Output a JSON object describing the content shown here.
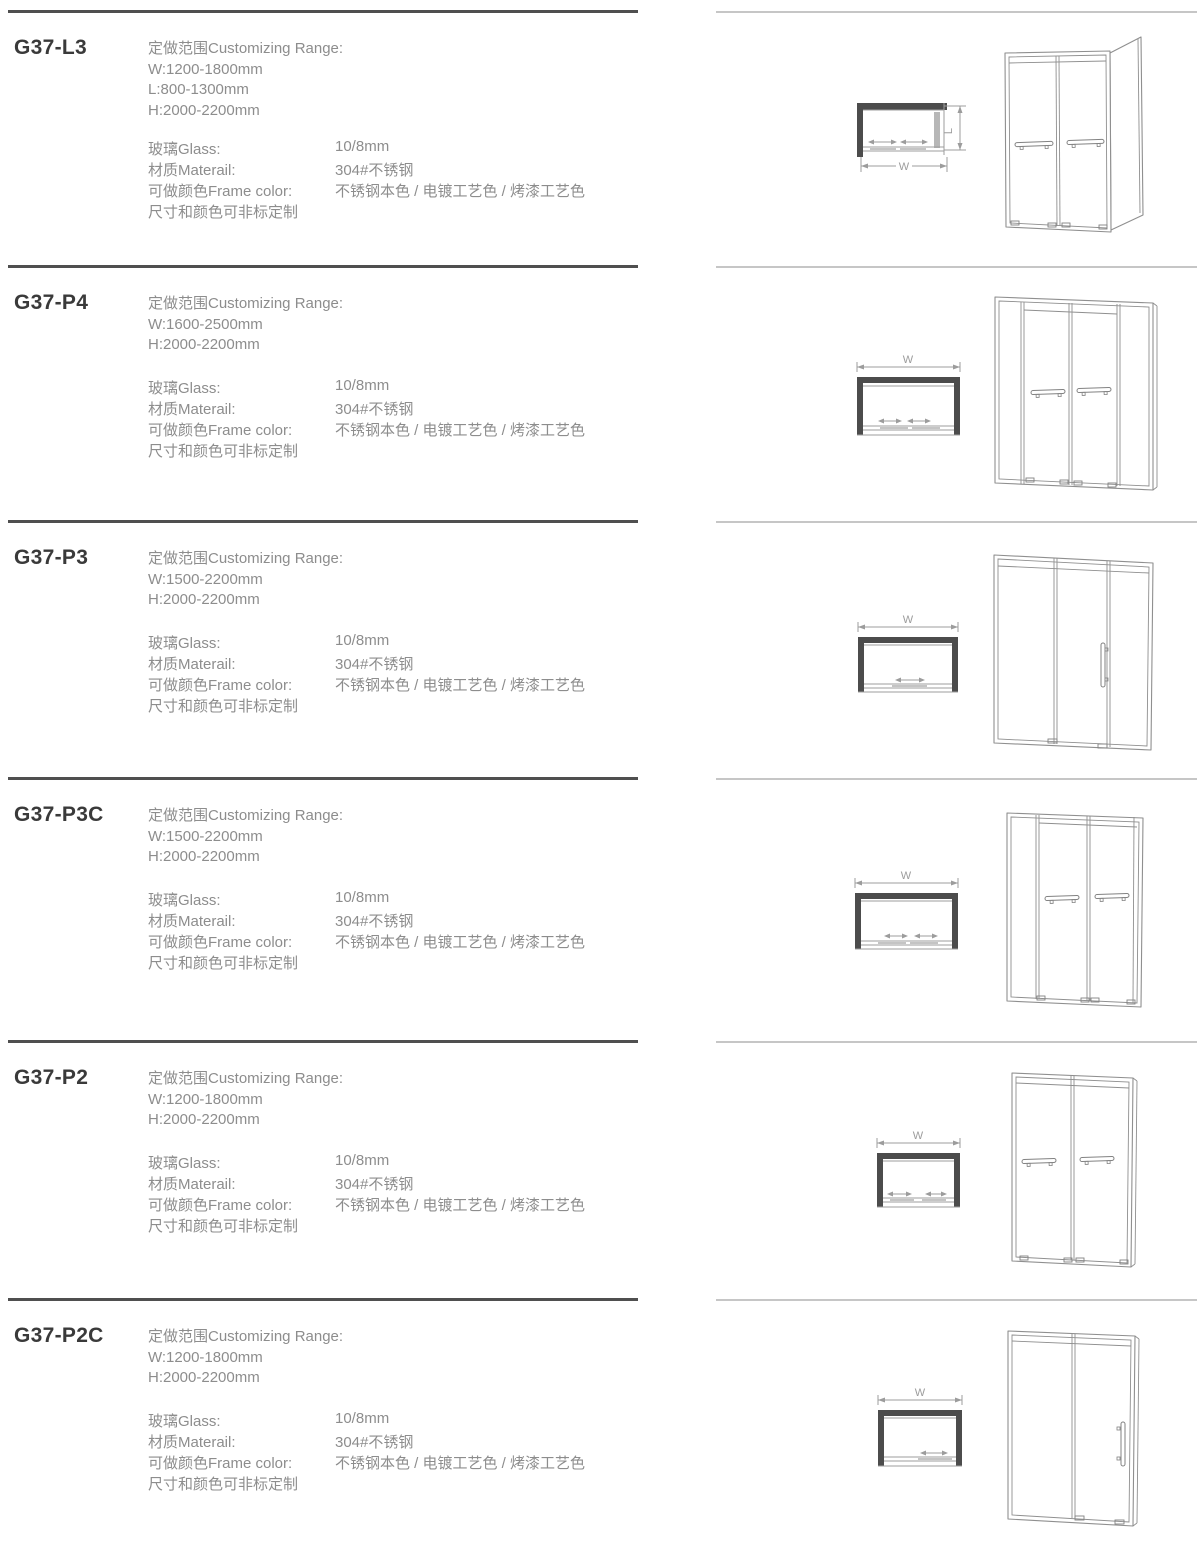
{
  "page": {
    "background": "#ffffff",
    "divider_dark_color": "#4f4f4f",
    "divider_light_color": "#c6c6c6",
    "model_text_color": "#3a3a3a",
    "body_text_color": "#8d8d8d"
  },
  "sections": [
    {
      "model": "G37-L3",
      "range_title": "定做范围Customizing Range:",
      "range_lines": [
        "W:1200-1800mm",
        "L:800-1300mm",
        "H:2000-2200mm"
      ],
      "specs": [
        {
          "label": "玻璃Glass:",
          "value": "10/8mm"
        },
        {
          "label": "材质Materail:",
          "value": "304#不锈钢"
        },
        {
          "label": "可做颜色Frame color:",
          "value": "不锈钢本色 / 电镀工艺色 / 烤漆工艺色"
        },
        {
          "label": "尺寸和颜色可非标定制",
          "value": ""
        }
      ],
      "dims": {
        "w": "W",
        "l": "L"
      }
    },
    {
      "model": "G37-P4",
      "range_title": "定做范围Customizing Range:",
      "range_lines": [
        "W:1600-2500mm",
        "H:2000-2200mm"
      ],
      "specs": [
        {
          "label": "玻璃Glass:",
          "value": "10/8mm"
        },
        {
          "label": "材质Materail:",
          "value": "304#不锈钢"
        },
        {
          "label": "可做颜色Frame color:",
          "value": "不锈钢本色 / 电镀工艺色 / 烤漆工艺色"
        },
        {
          "label": "尺寸和颜色可非标定制",
          "value": ""
        }
      ],
      "dims": {
        "w": "W"
      }
    },
    {
      "model": "G37-P3",
      "range_title": "定做范围Customizing Range:",
      "range_lines": [
        "W:1500-2200mm",
        "H:2000-2200mm"
      ],
      "specs": [
        {
          "label": "玻璃Glass:",
          "value": "10/8mm"
        },
        {
          "label": "材质Materail:",
          "value": "304#不锈钢"
        },
        {
          "label": "可做颜色Frame color:",
          "value": "不锈钢本色 / 电镀工艺色 / 烤漆工艺色"
        },
        {
          "label": "尺寸和颜色可非标定制",
          "value": ""
        }
      ],
      "dims": {
        "w": "W"
      }
    },
    {
      "model": "G37-P3C",
      "range_title": "定做范围Customizing Range:",
      "range_lines": [
        "W:1500-2200mm",
        "H:2000-2200mm"
      ],
      "specs": [
        {
          "label": "玻璃Glass:",
          "value": "10/8mm"
        },
        {
          "label": "材质Materail:",
          "value": "304#不锈钢"
        },
        {
          "label": "可做颜色Frame color:",
          "value": "不锈钢本色 / 电镀工艺色 / 烤漆工艺色"
        },
        {
          "label": "尺寸和颜色可非标定制",
          "value": ""
        }
      ],
      "dims": {
        "w": "W"
      }
    },
    {
      "model": "G37-P2",
      "range_title": "定做范围Customizing Range:",
      "range_lines": [
        "W:1200-1800mm",
        "H:2000-2200mm"
      ],
      "specs": [
        {
          "label": "玻璃Glass:",
          "value": "10/8mm"
        },
        {
          "label": "材质Materail:",
          "value": "304#不锈钢"
        },
        {
          "label": "可做颜色Frame color:",
          "value": "不锈钢本色 / 电镀工艺色 / 烤漆工艺色"
        },
        {
          "label": "尺寸和颜色可非标定制",
          "value": ""
        }
      ],
      "dims": {
        "w": "W"
      }
    },
    {
      "model": "G37-P2C",
      "range_title": "定做范围Customizing Range:",
      "range_lines": [
        "W:1200-1800mm",
        "H:2000-2200mm"
      ],
      "specs": [
        {
          "label": "玻璃Glass:",
          "value": "10/8mm"
        },
        {
          "label": "材质Materail:",
          "value": "304#不锈钢"
        },
        {
          "label": "可做颜色Frame color:",
          "value": "不锈钢本色 / 电镀工艺色 / 烤漆工艺色"
        },
        {
          "label": "尺寸和颜色可非标定制",
          "value": ""
        }
      ],
      "dims": {
        "w": "W"
      }
    }
  ]
}
